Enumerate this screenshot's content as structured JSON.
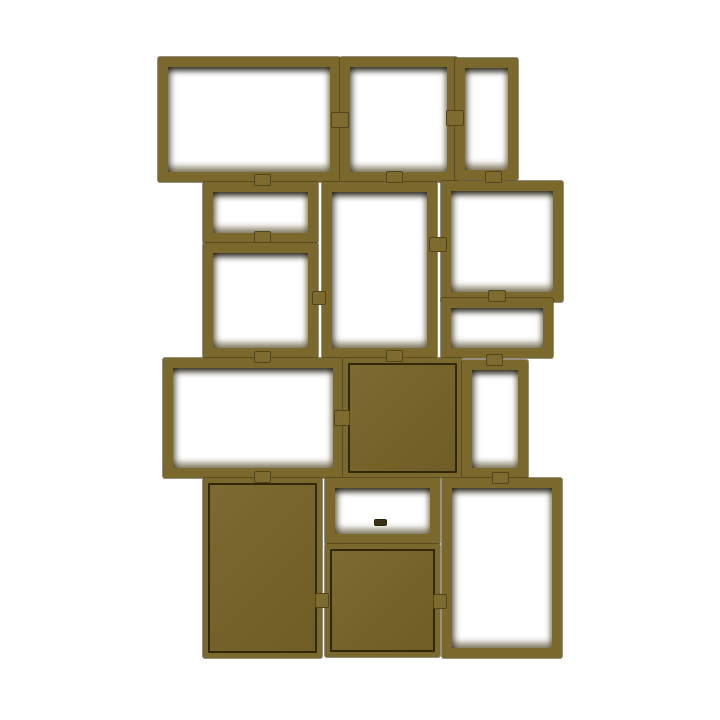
{
  "scene": {
    "background_color": "#ffffff",
    "description": "Product photo of an asymmetric stacked modular shelving unit in brown-green (olive) on a plain white background. Fifteen rectangular modules of varying sizes are stacked in four staggered rows; most modules are open frames, four have solid olive panels, and small clips join adjacent modules."
  },
  "product": {
    "kind": "modular-stacked-shelving",
    "color_name": "brown-green olive",
    "colors": {
      "frame": "#7a682c",
      "frame_seam": "#3e3514",
      "inner_shadow": "#16120533",
      "door_panel": "#76642b",
      "door_outline": "#2f2809",
      "connector": "#7d6b2f",
      "background": "#ffffff"
    }
  },
  "modules": [
    {
      "id": "top-wide-left",
      "type": "open",
      "x": 158,
      "y": 57,
      "w": 182,
      "h": 125
    },
    {
      "id": "top-middle",
      "type": "open",
      "x": 340,
      "y": 57,
      "w": 117,
      "h": 125
    },
    {
      "id": "top-right-narrow",
      "type": "open",
      "x": 455,
      "y": 58,
      "w": 63,
      "h": 122
    },
    {
      "id": "row2-left-short",
      "type": "open",
      "x": 203,
      "y": 182,
      "w": 115,
      "h": 61
    },
    {
      "id": "row2-left-tall",
      "type": "open",
      "x": 203,
      "y": 243,
      "w": 115,
      "h": 115
    },
    {
      "id": "row2-middle-tall",
      "type": "open",
      "x": 322,
      "y": 182,
      "w": 115,
      "h": 176
    },
    {
      "id": "row2-right",
      "type": "open",
      "x": 441,
      "y": 181,
      "w": 122,
      "h": 121
    },
    {
      "id": "row2-right-short",
      "type": "open",
      "x": 441,
      "y": 298,
      "w": 112,
      "h": 60
    },
    {
      "id": "row3-wide-left",
      "type": "open",
      "x": 163,
      "y": 358,
      "w": 180,
      "h": 120
    },
    {
      "id": "row3-middle-door",
      "type": "closed",
      "x": 343,
      "y": 358,
      "w": 119,
      "h": 120
    },
    {
      "id": "row3-right-narrow",
      "type": "open",
      "x": 462,
      "y": 360,
      "w": 66,
      "h": 118
    },
    {
      "id": "bottom-left-door",
      "type": "closed",
      "x": 203,
      "y": 478,
      "w": 119,
      "h": 180
    },
    {
      "id": "bottom-middle-shallow",
      "type": "open",
      "x": 325,
      "y": 478,
      "w": 115,
      "h": 66
    },
    {
      "id": "bottom-middle-door",
      "type": "closed",
      "x": 325,
      "y": 544,
      "w": 115,
      "h": 113
    },
    {
      "id": "bottom-right-tall",
      "type": "open",
      "x": 442,
      "y": 478,
      "w": 120,
      "h": 180
    }
  ],
  "connectors": [
    {
      "id": "clip-top-left-mid",
      "x": 331,
      "y": 112,
      "w": 18,
      "h": 16,
      "style": "olive"
    },
    {
      "id": "clip-top-right-mid",
      "x": 446,
      "y": 110,
      "w": 18,
      "h": 16,
      "style": "olive"
    },
    {
      "id": "clip-row2-mid-right",
      "x": 429,
      "y": 237,
      "w": 18,
      "h": 15,
      "style": "olive"
    },
    {
      "id": "clip-row2-mid-left",
      "x": 312,
      "y": 291,
      "w": 14,
      "h": 14,
      "style": "olive"
    },
    {
      "id": "clip-row3-mid",
      "x": 334,
      "y": 410,
      "w": 16,
      "h": 16,
      "style": "olive"
    },
    {
      "id": "clip-row4-mid-left",
      "x": 315,
      "y": 593,
      "w": 14,
      "h": 15,
      "style": "olive"
    },
    {
      "id": "clip-row4-mid-right",
      "x": 433,
      "y": 594,
      "w": 14,
      "h": 15,
      "style": "olive"
    },
    {
      "id": "clip-r1r2-left",
      "x": 254,
      "y": 174,
      "w": 17,
      "h": 12,
      "style": "olive"
    },
    {
      "id": "clip-r1r2-middle",
      "x": 386,
      "y": 171,
      "w": 17,
      "h": 12,
      "style": "olive"
    },
    {
      "id": "clip-r1r2-right",
      "x": 485,
      "y": 171,
      "w": 17,
      "h": 12,
      "style": "olive"
    },
    {
      "id": "clip-left-column",
      "x": 254,
      "y": 231,
      "w": 17,
      "h": 12,
      "style": "olive"
    },
    {
      "id": "clip-right-column",
      "x": 488,
      "y": 290,
      "w": 18,
      "h": 12,
      "style": "olive"
    },
    {
      "id": "clip-r2r3-left",
      "x": 254,
      "y": 351,
      "w": 17,
      "h": 12,
      "style": "olive"
    },
    {
      "id": "clip-r2r3-middle",
      "x": 386,
      "y": 350,
      "w": 17,
      "h": 12,
      "style": "olive"
    },
    {
      "id": "clip-r2r3-right",
      "x": 486,
      "y": 354,
      "w": 17,
      "h": 12,
      "style": "olive"
    },
    {
      "id": "clip-r3r4-left",
      "x": 254,
      "y": 471,
      "w": 17,
      "h": 12,
      "style": "olive"
    },
    {
      "id": "clip-r3r4-right",
      "x": 492,
      "y": 472,
      "w": 17,
      "h": 12,
      "style": "olive"
    },
    {
      "id": "clip-shelf-middle",
      "x": 374,
      "y": 519,
      "w": 13,
      "h": 7,
      "style": "dark"
    }
  ]
}
